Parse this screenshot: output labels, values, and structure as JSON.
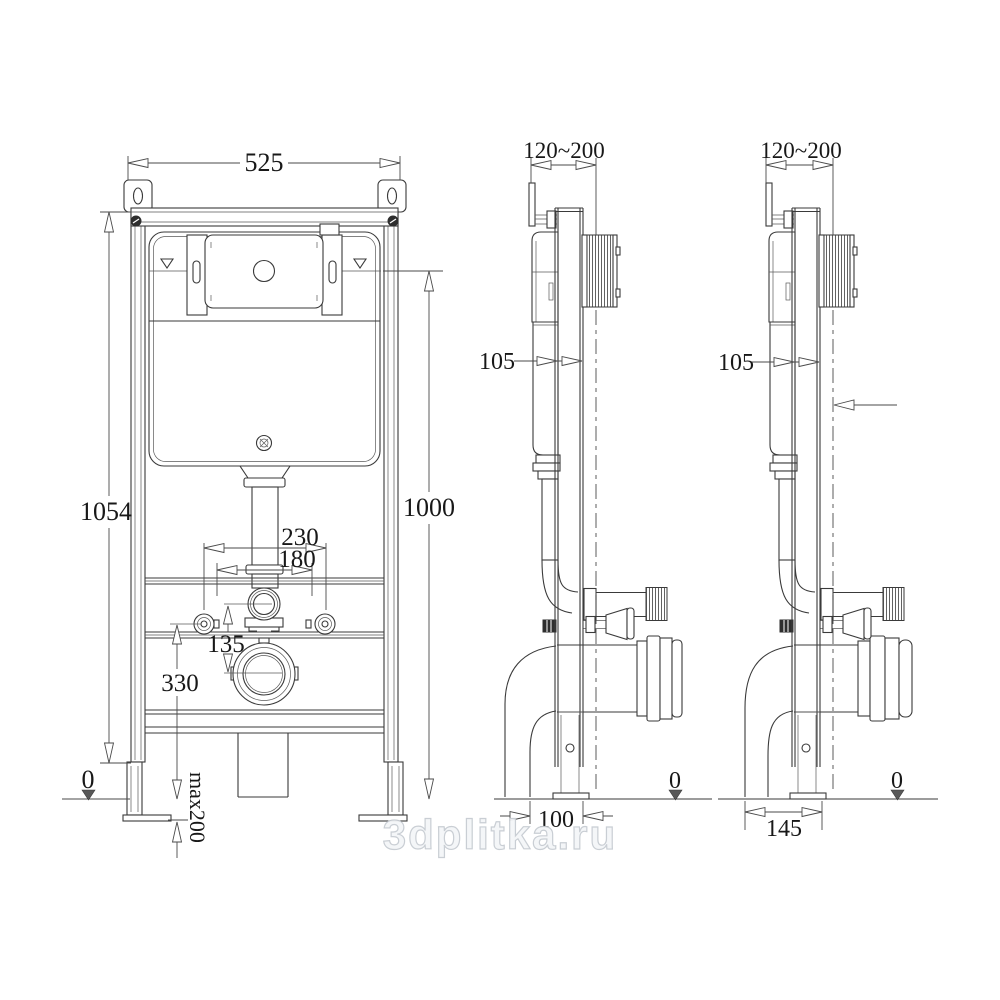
{
  "watermark": {
    "text": "3dplitka.ru"
  },
  "front_view": {
    "dim_width": "525",
    "dim_height_total": "1054",
    "dim_height_flush_axis": "1000",
    "dim_stud_spacing_outer": "230",
    "dim_stud_spacing_inner": "180",
    "dim_flush_to_drain": "135",
    "dim_drain_axis_height": "330",
    "datum_zero": "0",
    "leg_adjust_max": "max200"
  },
  "side_view_left": {
    "range_to_wall": "120~200",
    "depth": "105",
    "base_depth": "100",
    "datum_zero": "0"
  },
  "side_view_right": {
    "range_to_wall": "120~200",
    "depth": "105",
    "base_depth": "145",
    "datum_zero": "0"
  },
  "colors": {
    "line": "#3a3a3a",
    "watermark_outline": "#c7ccd2"
  }
}
